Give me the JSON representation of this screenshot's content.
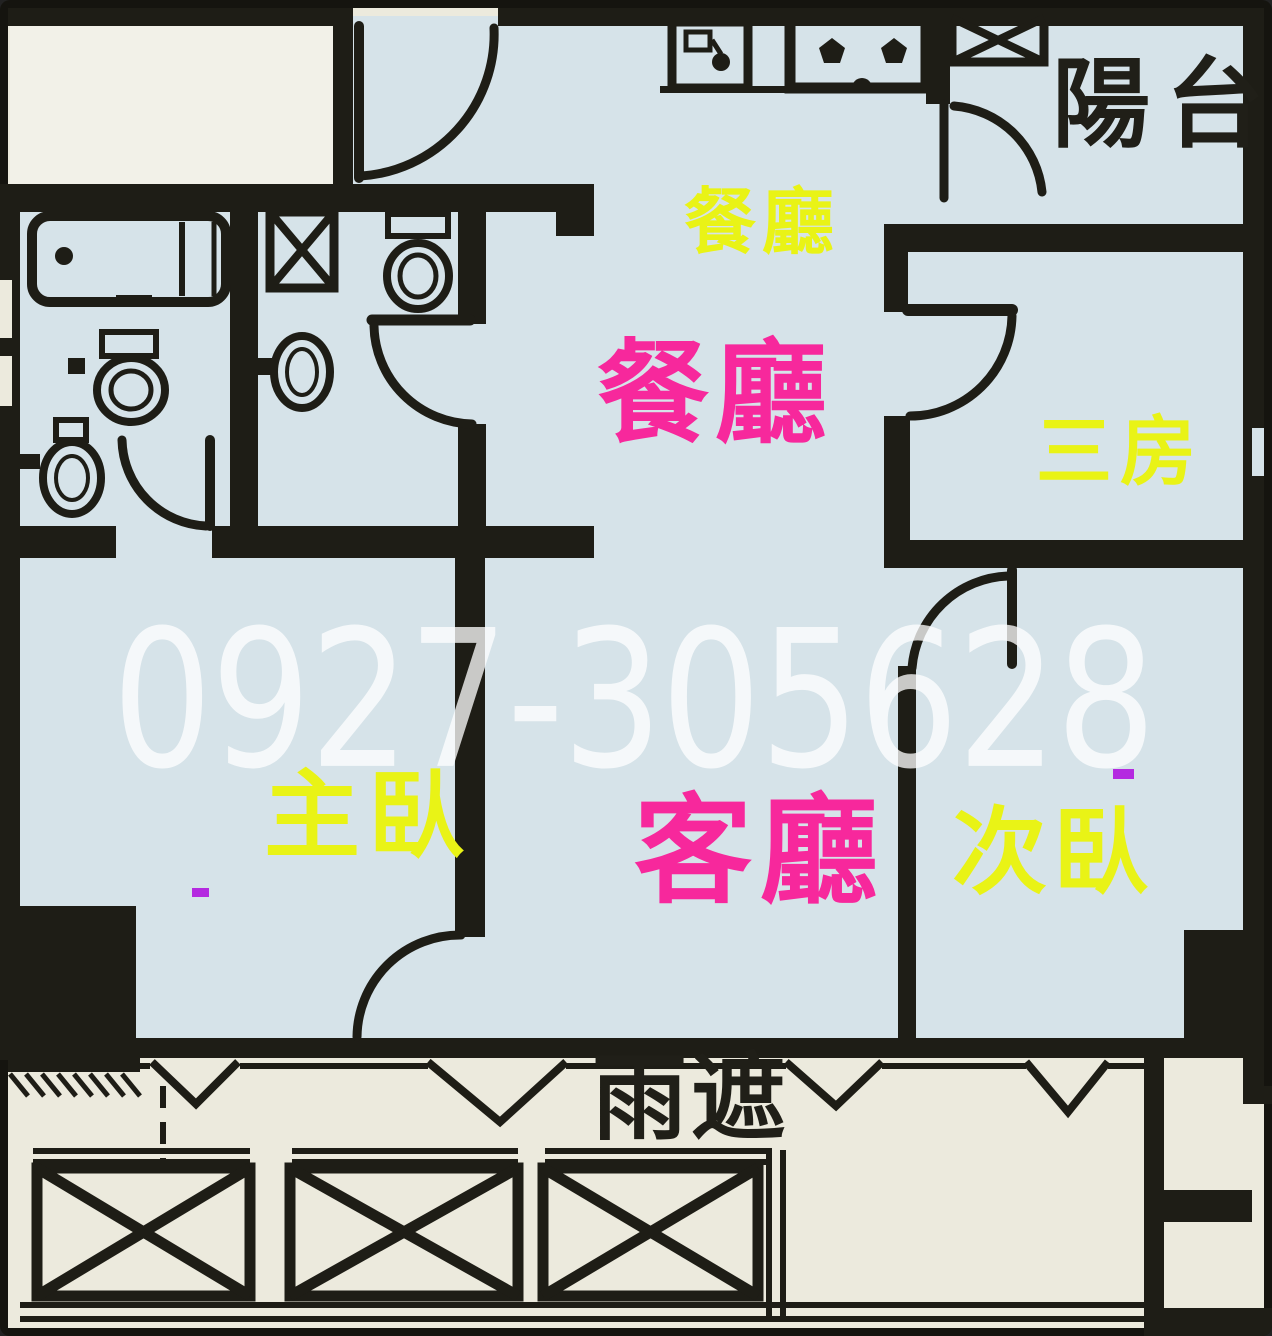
{
  "plan": {
    "type": "apartment-floor-plan",
    "watermark_phone": "0927-305628",
    "labels": {
      "balcony": {
        "text": "陽台",
        "color": "#201f18"
      },
      "kitchen": {
        "text": "餐廳",
        "color": "#e9f316"
      },
      "dining": {
        "text": "餐廳",
        "color": "#f7289c"
      },
      "third_room": {
        "text": "三房",
        "color": "#e9f316"
      },
      "master_bedroom": {
        "text": "主臥",
        "color": "#e9f316"
      },
      "living_room": {
        "text": "客廳",
        "color": "#f7289c"
      },
      "second_bedroom": {
        "text": "次臥",
        "color": "#e9f316"
      },
      "rain_shade": {
        "text": "雨遮",
        "color": "#201f18"
      }
    },
    "colors": {
      "wall": "#1e1d16",
      "room_fill": "#d6e3e9",
      "exterior_fill": "#eceadd",
      "entry_box_fill": "#f2f1e8",
      "label_yellow": "#e9f316",
      "label_pink": "#f7289c",
      "watermark_white": "#ffffff",
      "annotation_purple": "#b42ae0"
    },
    "fixtures": [
      "bathtub",
      "toilet",
      "wash-basin",
      "gas-stove",
      "kitchen-sink",
      "pipe-shaft-x",
      "door-swing-arc",
      "window-mark",
      "x-braced-slab"
    ]
  }
}
